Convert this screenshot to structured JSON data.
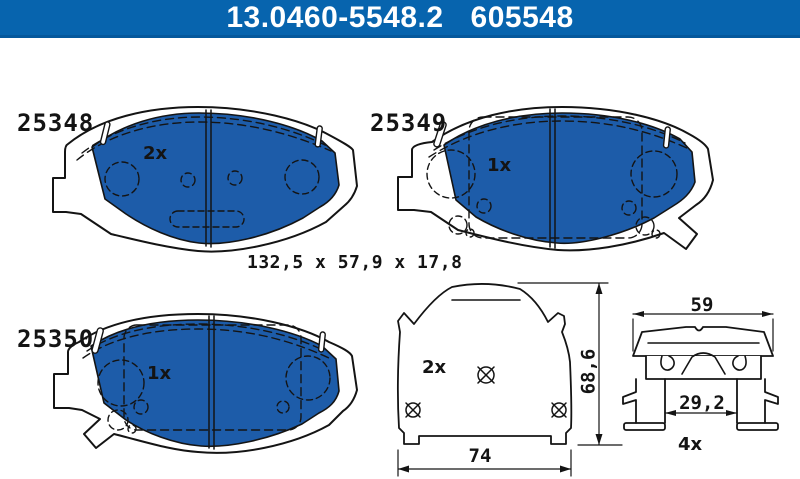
{
  "header": {
    "catalog_number": "13.0460-5548.2",
    "order_number": "605548"
  },
  "dimensions_note": "132,5 x 57,9 x 17,8",
  "parts": {
    "pad1": {
      "label": "25348",
      "qty": "2x"
    },
    "pad2": {
      "label": "25349",
      "qty": "1x"
    },
    "pad3": {
      "label": "25350",
      "qty": "1x"
    },
    "backplate": {
      "qty": "2x",
      "dim_width": "74",
      "dim_height": "68,6"
    },
    "clip": {
      "qty": "4x",
      "dim_width": "59",
      "dim_inner": "29,2"
    }
  },
  "colors": {
    "header_blue": "#0764ae",
    "pad_blue": "#1d5ca9",
    "line": "#141414",
    "background": "#ffffff"
  }
}
